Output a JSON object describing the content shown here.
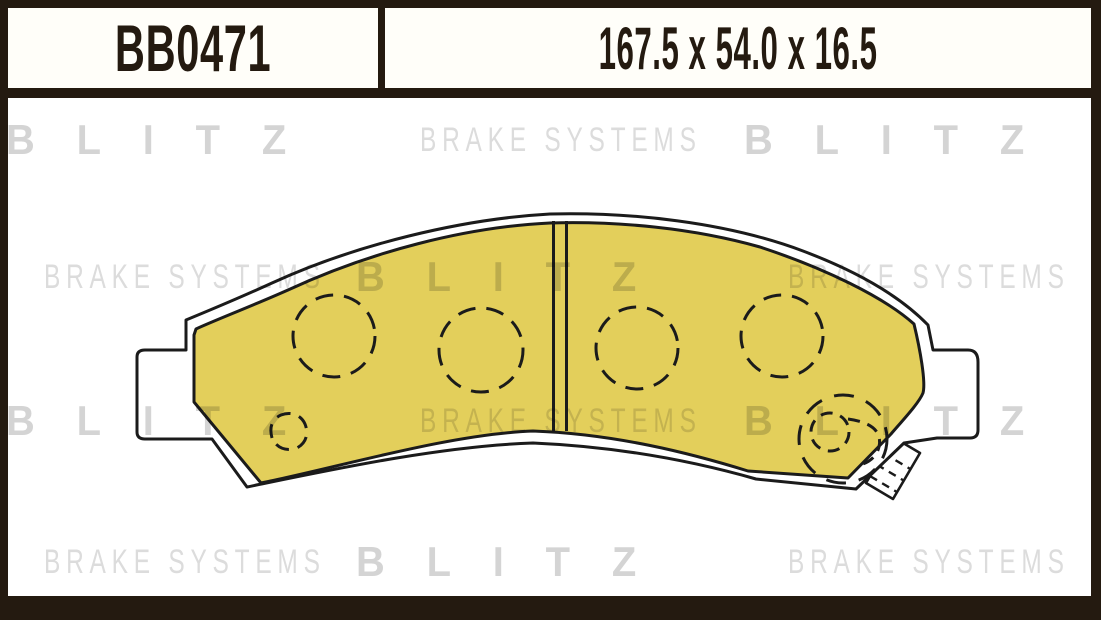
{
  "header": {
    "part_number": "BB0471",
    "dimensions": "167.5 x 54.0 x 16.5"
  },
  "watermark": {
    "brand": "BLITZ",
    "tagline": "BRAKE SYSTEMS",
    "rows": [
      {
        "items": [
          "BLITZ",
          "BRAKE SYSTEMS",
          "BLITZ"
        ]
      },
      {
        "items": [
          "BRAKE SYSTEMS",
          "BLITZ",
          "BRAKE SYSTEMS"
        ]
      },
      {
        "items": [
          "BLITZ",
          "BRAKE SYSTEMS",
          "BLITZ"
        ]
      },
      {
        "items": [
          "BRAKE SYSTEMS",
          "BLITZ",
          "BRAKE SYSTEMS"
        ]
      }
    ]
  },
  "drawing": {
    "type": "brake-pad-technical-drawing",
    "pad_color": "#e3cf5b",
    "backing_color": "#ffffff",
    "outline_color": "#1b1b1b",
    "guide_hole_count": 4,
    "has_center_slot": true,
    "has_wear_indicator": true
  },
  "frame": {
    "border_color": "#241a10",
    "background_color": "#ffffff"
  }
}
